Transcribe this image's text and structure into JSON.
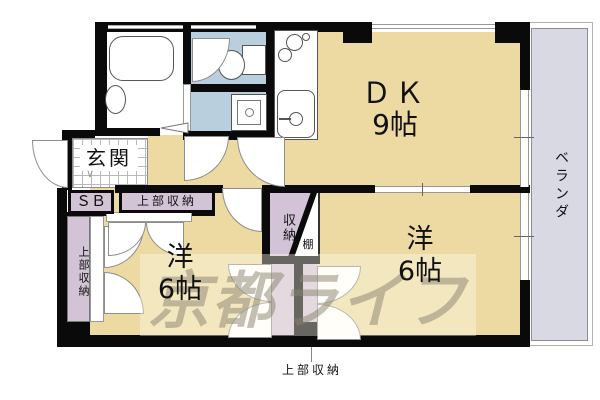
{
  "plan": {
    "watermark": "京都ライフ",
    "rooms": {
      "dk": {
        "name": "ＤＫ",
        "size": "9帖"
      },
      "west_left": {
        "name": "洋",
        "size": "6帖"
      },
      "west_right": {
        "name": "洋",
        "size": "6帖"
      },
      "entrance": {
        "name": "玄関"
      },
      "veranda": {
        "name": "ベランダ"
      }
    },
    "storage": {
      "shoe_box": "ＳＢ",
      "upper_top": "上部収納",
      "upper_left": "上部収納",
      "closet": "収納",
      "shelf": "棚",
      "upper_bottom": "上部収納"
    },
    "marks": {
      "step": "∨"
    },
    "colors": {
      "floor": "#ecdaa2",
      "wet_area": "#b9cfdd",
      "closet": "#d2c3d6",
      "veranda": "#d9d9e3",
      "wall": "#0a0a0a",
      "fixture_line": "#555555",
      "watermark": "#8a8270"
    }
  }
}
